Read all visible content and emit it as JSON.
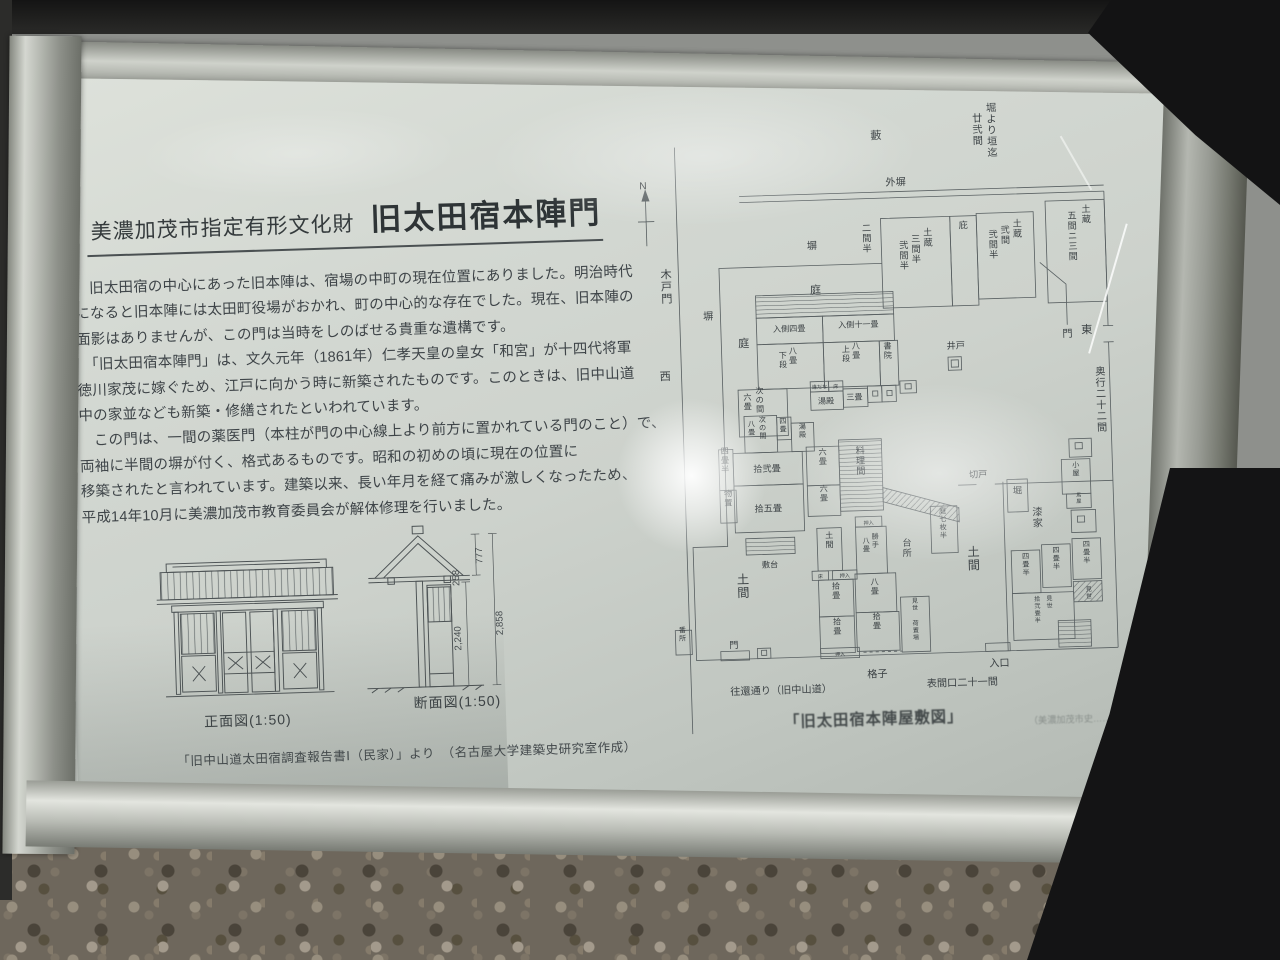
{
  "colors": {
    "panel": "#d3d8d2",
    "ink": "#3c4245",
    "frame_metal": "#c9ccc7",
    "background_dark": "#141414",
    "gravel": "#6e675c"
  },
  "sign": {
    "designation": "美濃加茂市指定有形文化財",
    "title": "旧太田宿本陣門",
    "paragraphs": [
      "　旧太田宿の中心にあった旧本陣は、宿場の中町の現在位置にありました。明治時代",
      "になると旧本陣には太田町役場がおかれ、町の中心的な存在でした。現在、旧本陣の",
      "面影はありませんが、この門は当時をしのばせる貴重な遺構です。",
      "　「旧太田宿本陣門」は、文久元年（1861年）仁孝天皇の皇女「和宮」が十四代将軍",
      "徳川家茂に嫁ぐため、江戸に向かう時に新築されたものです。このときは、旧中山道",
      "中の家並なども新築・修繕されたといわれています。",
      "　この門は、一間の薬医門（本柱が門の中心線上より前方に置かれている門のこと）で、",
      "両袖に半間の塀が付く、格式あるものです。昭和の初めの頃に現在の位置に",
      "移築されたと言われています。建築以来、長い年月を経て痛みが激しくなったため、",
      "平成14年10月に美濃加茂市教育委員会が解体修理を行いました。"
    ],
    "drawings": {
      "front_caption": "正面図(1:50)",
      "section_caption": "断面図(1:50)",
      "dimensions": {
        "eaves": "258",
        "opening": "2,240",
        "roof": "777",
        "total": "2,858"
      },
      "source": "「旧中山道太田宿調査報告書Ⅰ（民家）」より　（名古屋大学建築史研究室作成）"
    },
    "plan": {
      "caption": "「旧太田宿本陣屋敷図」",
      "caption_source": "（美濃加茂市史……より）",
      "labels": [
        {
          "t": "N",
          "x": 18,
          "y": 92,
          "o": "h",
          "s": 10
        },
        {
          "t": "木戸門",
          "x": 38,
          "y": 180,
          "o": "v",
          "s": 11
        },
        {
          "t": "西",
          "x": 34,
          "y": 280,
          "o": "h",
          "s": 11
        },
        {
          "t": "藪",
          "x": 248,
          "y": 50,
          "o": "h",
          "s": 11
        },
        {
          "t": "堀より垣迄",
          "x": 362,
          "y": 26,
          "o": "v",
          "s": 10
        },
        {
          "t": "廿弐間",
          "x": 348,
          "y": 36,
          "o": "v",
          "s": 10
        },
        {
          "t": "外塀",
          "x": 266,
          "y": 96,
          "o": "h",
          "s": 10
        },
        {
          "t": "二間半",
          "x": 236,
          "y": 140,
          "o": "v",
          "s": 9
        },
        {
          "t": "土蔵",
          "x": 296,
          "y": 146,
          "o": "v",
          "s": 9
        },
        {
          "t": "三間半",
          "x": 284,
          "y": 152,
          "o": "v",
          "s": 9
        },
        {
          "t": "弐間半",
          "x": 272,
          "y": 158,
          "o": "v",
          "s": 9
        },
        {
          "t": "庇",
          "x": 331,
          "y": 140,
          "o": "v",
          "s": 9
        },
        {
          "t": "土蔵",
          "x": 384,
          "y": 140,
          "o": "v",
          "s": 9
        },
        {
          "t": "弐間",
          "x": 372,
          "y": 146,
          "o": "v",
          "s": 9
        },
        {
          "t": "弐間半",
          "x": 360,
          "y": 150,
          "o": "v",
          "s": 9
        },
        {
          "t": "土蔵",
          "x": 452,
          "y": 128,
          "o": "v",
          "s": 9
        },
        {
          "t": "五間ニ三間",
          "x": 438,
          "y": 134,
          "o": "v",
          "s": 9
        },
        {
          "t": "塀",
          "x": 182,
          "y": 156,
          "o": "h",
          "s": 10
        },
        {
          "t": "庭",
          "x": 184,
          "y": 200,
          "o": "h",
          "s": 11
        },
        {
          "t": "塀",
          "x": 78,
          "y": 222,
          "o": "h",
          "s": 10
        },
        {
          "t": "庭",
          "x": 112,
          "y": 250,
          "o": "h",
          "s": 11
        },
        {
          "t": "井戸",
          "x": 320,
          "y": 258,
          "o": "h",
          "s": 9
        },
        {
          "t": "門",
          "x": 430,
          "y": 250,
          "o": "h",
          "s": 10
        },
        {
          "t": "東",
          "x": 449,
          "y": 247,
          "o": "h",
          "s": 11
        },
        {
          "t": "奥行二十二間",
          "x": 461,
          "y": 288,
          "o": "v",
          "s": 10
        },
        {
          "t": "入側四畳",
          "x": 157,
          "y": 236,
          "o": "h",
          "s": 8
        },
        {
          "t": "入側十一畳",
          "x": 225,
          "y": 234,
          "o": "h",
          "s": 8
        },
        {
          "t": "八畳",
          "x": 160,
          "y": 258,
          "o": "v",
          "s": 8
        },
        {
          "t": "下段",
          "x": 150,
          "y": 262,
          "o": "v",
          "s": 8
        },
        {
          "t": "八畳",
          "x": 222,
          "y": 255,
          "o": "v",
          "s": 8
        },
        {
          "t": "上段",
          "x": 212,
          "y": 258,
          "o": "v",
          "s": 8
        },
        {
          "t": "書院",
          "x": 253,
          "y": 256,
          "o": "v",
          "s": 8
        },
        {
          "t": "次の間",
          "x": 126,
          "y": 296,
          "o": "v",
          "s": 8
        },
        {
          "t": "六畳",
          "x": 114,
          "y": 302,
          "o": "v",
          "s": 8
        },
        {
          "t": "違だな",
          "x": 185,
          "y": 293,
          "o": "h",
          "s": 5
        },
        {
          "t": "床",
          "x": 201,
          "y": 293,
          "o": "h",
          "s": 5
        },
        {
          "t": "湯殿",
          "x": 191,
          "y": 308,
          "o": "h",
          "s": 8
        },
        {
          "t": "三畳",
          "x": 219,
          "y": 305,
          "o": "h",
          "s": 8
        },
        {
          "t": "次の間",
          "x": 128,
          "y": 324,
          "o": "v",
          "s": 7
        },
        {
          "t": "八畳",
          "x": 117,
          "y": 328,
          "o": "v",
          "s": 7
        },
        {
          "t": "四畳",
          "x": 148,
          "y": 326,
          "o": "v",
          "s": 7
        },
        {
          "t": "湯殿",
          "x": 167,
          "y": 332,
          "o": "v",
          "s": 7
        },
        {
          "t": "四畳半",
          "x": 90,
          "y": 354,
          "o": "v",
          "s": 8
        },
        {
          "t": "拾弐畳",
          "x": 131,
          "y": 373,
          "o": "h",
          "s": 9
        },
        {
          "t": "物置",
          "x": 92,
          "y": 396,
          "o": "v",
          "s": 8
        },
        {
          "t": "拾五畳",
          "x": 131,
          "y": 412,
          "o": "h",
          "s": 9
        },
        {
          "t": "六畳",
          "x": 186,
          "y": 358,
          "o": "v",
          "s": 8
        },
        {
          "t": "六畳",
          "x": 186,
          "y": 394,
          "o": "v",
          "s": 8
        },
        {
          "t": "料理間",
          "x": 223,
          "y": 358,
          "o": "v",
          "s": 9
        },
        {
          "t": "敷台",
          "x": 131,
          "y": 467,
          "o": "h",
          "s": 8
        },
        {
          "t": "土間",
          "x": 104,
          "y": 482,
          "o": "v",
          "s": 12
        },
        {
          "t": "番所",
          "x": 43,
          "y": 528,
          "o": "v",
          "s": 7
        },
        {
          "t": "門",
          "x": 93,
          "y": 545,
          "o": "h",
          "s": 9
        },
        {
          "t": "切戸",
          "x": 338,
          "y": 385,
          "o": "h",
          "s": 9
        },
        {
          "t": "堀",
          "x": 376,
          "y": 402,
          "o": "v",
          "s": 9
        },
        {
          "t": "庭七枚半",
          "x": 302,
          "y": 419,
          "o": "v",
          "s": 7
        },
        {
          "t": "台所",
          "x": 266,
          "y": 450,
          "o": "v",
          "s": 9
        },
        {
          "t": "押入",
          "x": 229,
          "y": 428,
          "o": "h",
          "s": 5
        },
        {
          "t": "勝手",
          "x": 235,
          "y": 442,
          "o": "v",
          "s": 7
        },
        {
          "t": "八畳",
          "x": 226,
          "y": 446,
          "o": "v",
          "s": 7
        },
        {
          "t": "土間",
          "x": 190,
          "y": 440,
          "o": "v",
          "s": 8
        },
        {
          "t": "床",
          "x": 180,
          "y": 479,
          "o": "h",
          "s": 5
        },
        {
          "t": "押入",
          "x": 204,
          "y": 479,
          "o": "h",
          "s": 5
        },
        {
          "t": "拾畳",
          "x": 195,
          "y": 490,
          "o": "v",
          "s": 8
        },
        {
          "t": "八畳",
          "x": 233,
          "y": 487,
          "o": "v",
          "s": 8
        },
        {
          "t": "拾畳",
          "x": 195,
          "y": 525,
          "o": "v",
          "s": 8
        },
        {
          "t": "拾畳",
          "x": 234,
          "y": 521,
          "o": "v",
          "s": 8
        },
        {
          "t": "見世",
          "x": 272,
          "y": 506,
          "o": "v",
          "s": 6
        },
        {
          "t": "荷置場",
          "x": 272,
          "y": 528,
          "o": "v",
          "s": 6
        },
        {
          "t": "土間",
          "x": 331,
          "y": 462,
          "o": "v",
          "s": 12
        },
        {
          "t": "漆家",
          "x": 395,
          "y": 424,
          "o": "v",
          "s": 10
        },
        {
          "t": "小屋",
          "x": 434,
          "y": 378,
          "o": "v",
          "s": 7
        },
        {
          "t": "馬屋",
          "x": 436,
          "y": 407,
          "o": "v",
          "s": 5
        },
        {
          "t": "四畳半",
          "x": 382,
          "y": 466,
          "o": "v",
          "s": 7
        },
        {
          "t": "四畳半",
          "x": 412,
          "y": 461,
          "o": "v",
          "s": 7
        },
        {
          "t": "四畳半",
          "x": 442,
          "y": 456,
          "o": "v",
          "s": 7
        },
        {
          "t": "見世",
          "x": 404,
          "y": 508,
          "o": "v",
          "s": 6
        },
        {
          "t": "拾弐畳半",
          "x": 392,
          "y": 508,
          "o": "v",
          "s": 6
        },
        {
          "t": "見世",
          "x": 443,
          "y": 500,
          "o": "v",
          "s": 6
        },
        {
          "t": "押入",
          "x": 197,
          "y": 556,
          "o": "h",
          "s": 5
        },
        {
          "t": "格子",
          "x": 233,
          "y": 578,
          "o": "h",
          "s": 10
        },
        {
          "t": "入口",
          "x": 353,
          "y": 571,
          "o": "h",
          "s": 10
        },
        {
          "t": "表間口二十一間",
          "x": 316,
          "y": 589,
          "o": "h",
          "s": 10
        },
        {
          "t": "往還通り（旧中山道）",
          "x": 138,
          "y": 591,
          "o": "h",
          "s": 10
        },
        {
          "t": "「旧太田宿本陣屋敷図」",
          "x": 228,
          "y": 624,
          "o": "h",
          "s": 15,
          "c": "deg"
        },
        {
          "t": "（美濃加茂市史……より）",
          "x": 434,
          "y": 628,
          "o": "h",
          "s": 9,
          "c": "faint"
        }
      ]
    }
  }
}
